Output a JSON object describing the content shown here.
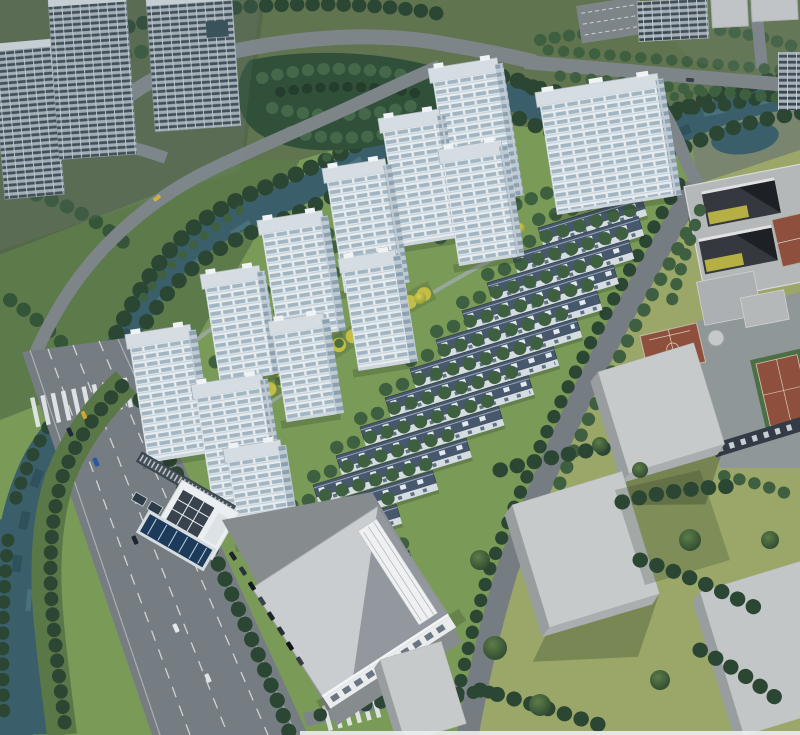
{
  "scene": {
    "name": "Aerial architectural rendering of a riverside residential development masterplan",
    "view": "bird's-eye perspective, daylight",
    "type": "architectural-render"
  },
  "palette": {
    "water": "#3a5f6b",
    "water_deep": "#27454e",
    "lawn": "#7a9a58",
    "lawn_context": "#9aa768",
    "ground_context": "#55684a",
    "tree_dark": "#2b4733",
    "tree_mid": "#3f6040",
    "tree_light": "#58793f",
    "tree_yellow": "#c3bd45",
    "road": "#767d82",
    "road_minor": "#7d8589",
    "lane_marking": "#dde1e3",
    "tower_face": "#e7ecef",
    "tower_side": "#bfcad2",
    "tower_roof": "#d6dde2",
    "window_glass": "#a2b5c3",
    "townhouse_roof": "#47576c",
    "townhouse_wall": "#d5dde3",
    "context_facade": "#a7b2ba",
    "context_window": "#3a4750",
    "massing_top": "#c7cacb",
    "massing_side": "#989da0",
    "court_red": "#8e4f3d",
    "pool_blue": "#1d3a5a",
    "solar_dark": "#39434d",
    "plaza_gray": "#8f9798"
  },
  "elements": {
    "residential_towers": {
      "count": 12,
      "style": "white high-rise slabs, banded glazing, light flat roofs"
    },
    "townhouse_rows": {
      "count": 13,
      "style": "attached low-rise rows, dark blue-grey roofs with skylights"
    },
    "context_towers": {
      "count": 3,
      "style": "grey towers with dark window grids (upper-left)"
    },
    "context_massing_blocks": {
      "count": 7,
      "style": "untextured grey volumes (right and bottom)"
    },
    "school_campus": {
      "courtyard_buildings": 1,
      "courtyards": 2,
      "sports_courts": 3
    },
    "water": "canal wrapping the north and west of the site, widening along the left edge",
    "roads": [
      "south-west multi-lane arterial with dashed lane markings, crosswalks and cars",
      "canal-side road on the north-west bank",
      "east collector road between townhouses and campus",
      "north loop road with canal bridge"
    ],
    "amenities": [
      "outdoor lap pool with lane lines",
      "clubhouse with rooftop solar array",
      "solar-panel canopy walk",
      "linear yellow-green landscape axis",
      "basketball court"
    ],
    "vehicles": {
      "moving_cars": 8,
      "parked_cars": 8
    }
  }
}
